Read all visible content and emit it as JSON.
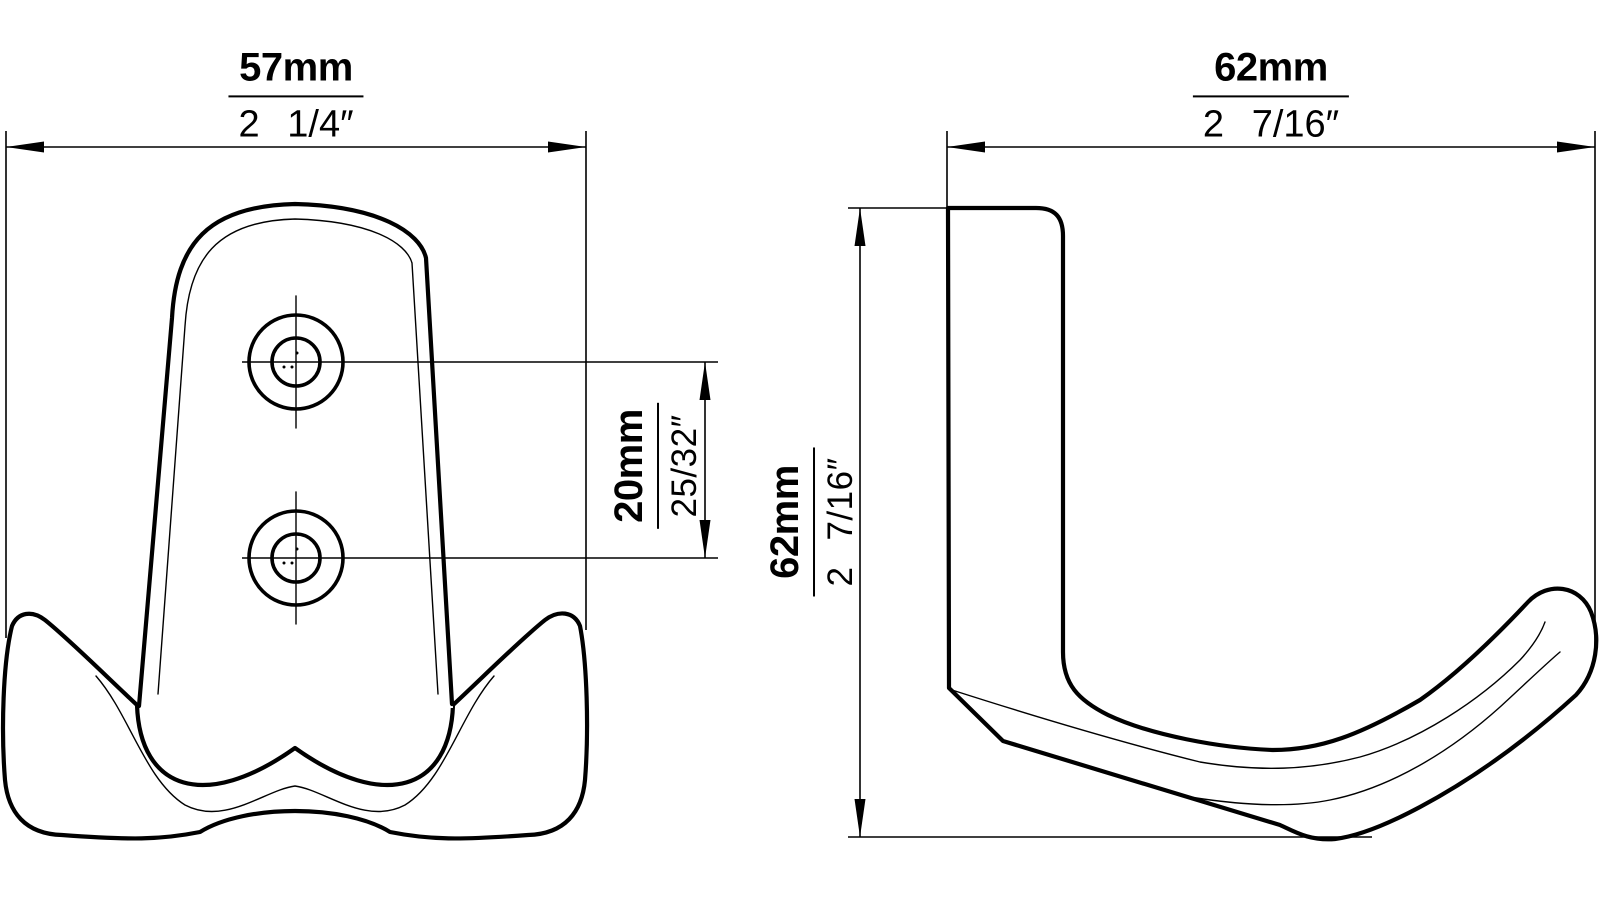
{
  "colors": {
    "line": "#000000",
    "background": "#ffffff"
  },
  "views": {
    "front": {
      "width": {
        "mm": "57mm",
        "inch": "2 1/4″"
      },
      "hole_spacing": {
        "mm": "20mm",
        "inch": "25/32″"
      }
    },
    "side": {
      "width": {
        "mm": "62mm",
        "inch": "2 7/16″"
      },
      "height": {
        "mm": "62mm",
        "inch": "2 7/16″"
      }
    }
  }
}
